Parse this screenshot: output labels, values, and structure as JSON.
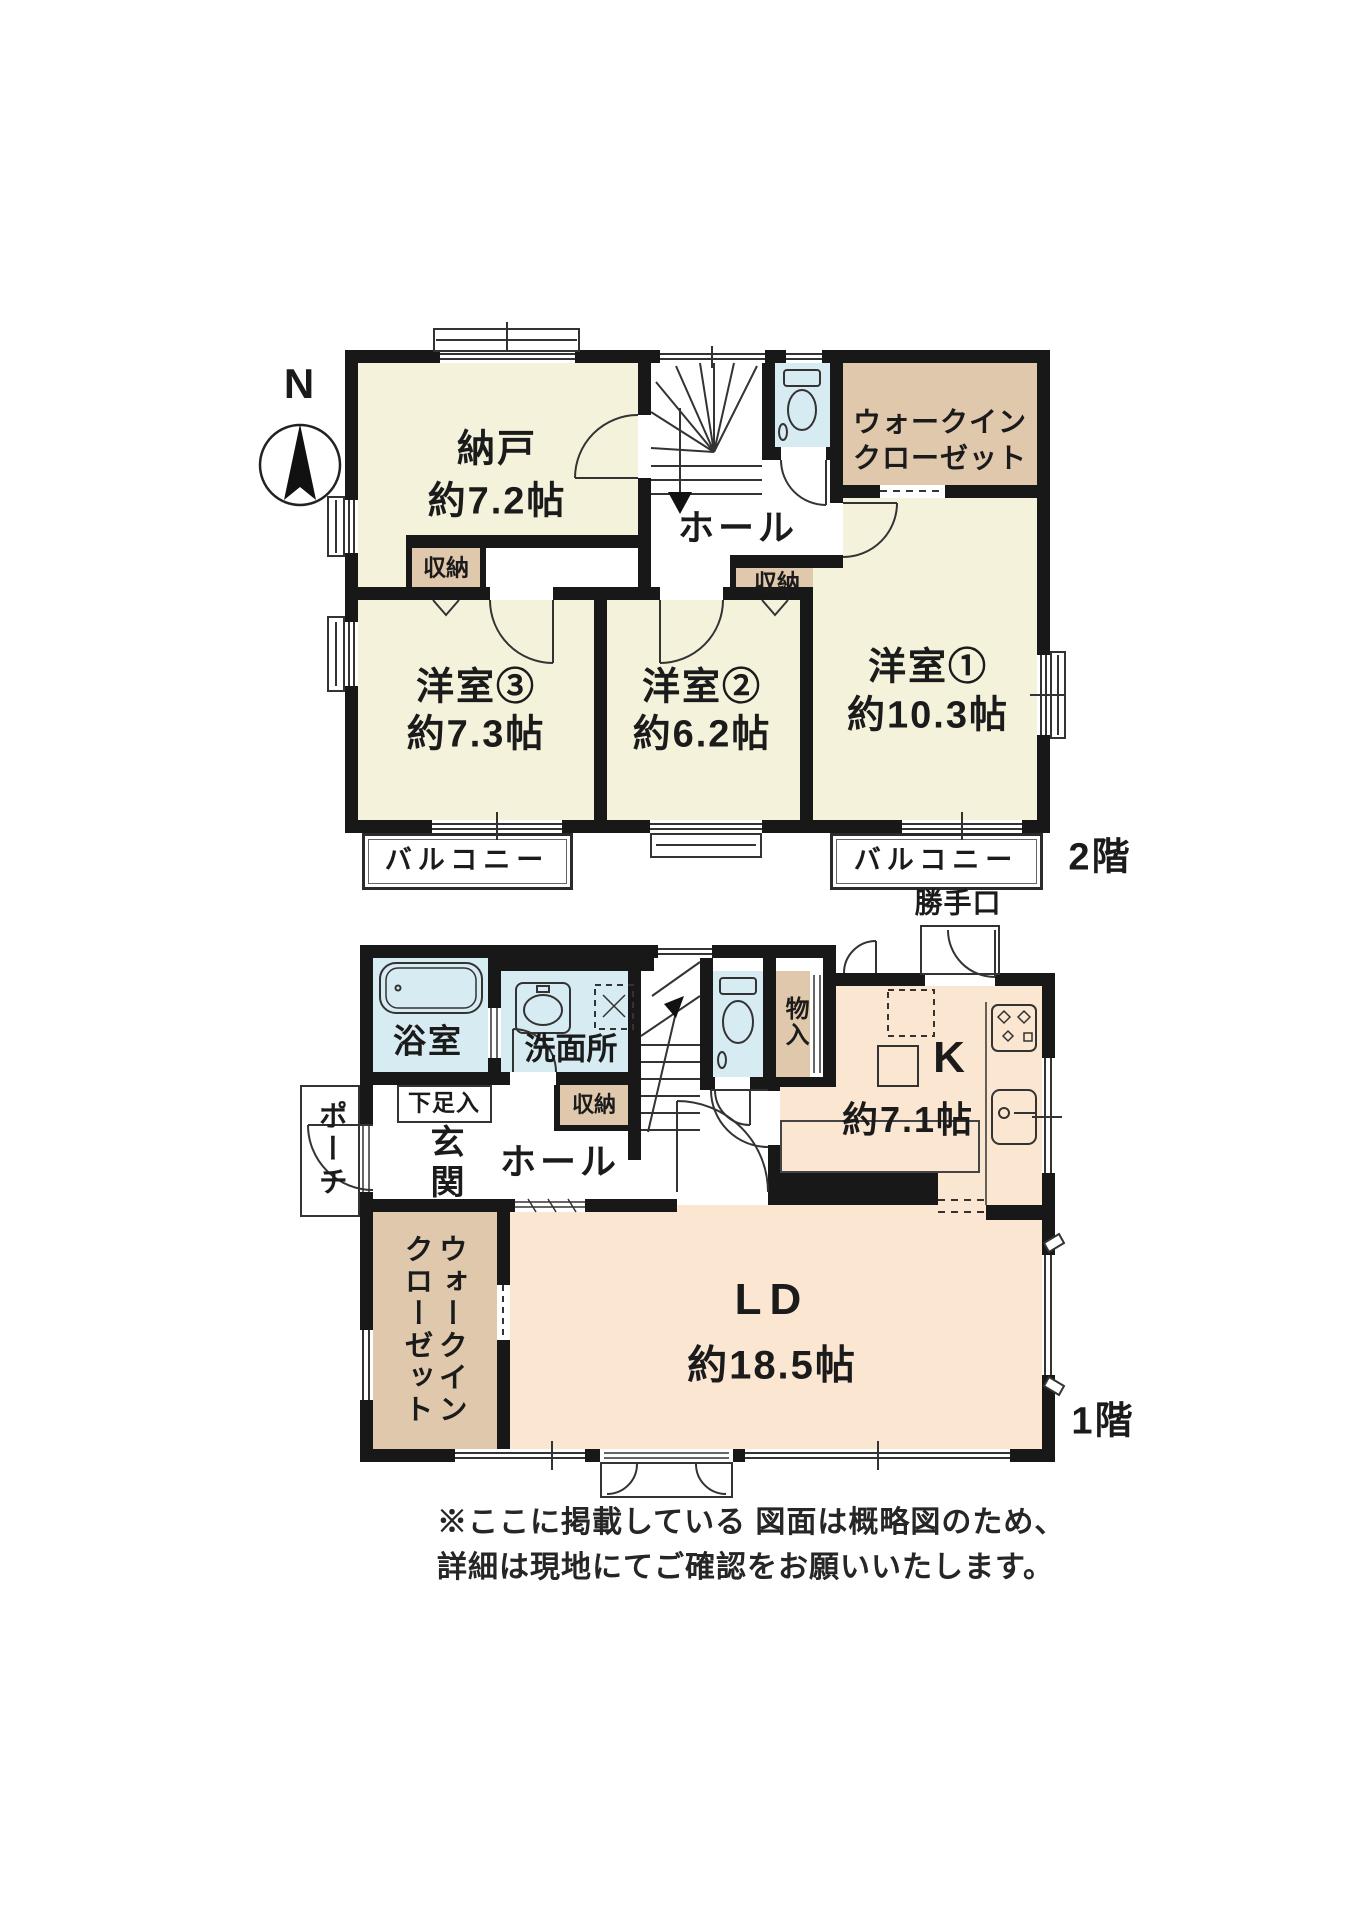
{
  "compass": {
    "north_label": "N"
  },
  "floor2": {
    "floor_label": "2階",
    "nando_label": "納戸",
    "nando_size": "約7.2帖",
    "hall_label": "ホール",
    "wic_line1": "ウォークイン",
    "wic_line2": "クローゼット",
    "storage_left_label": "収納",
    "storage_right_label": "収納",
    "room3_label": "洋室③",
    "room3_size": "約7.3帖",
    "room2_label": "洋室②",
    "room2_size": "約6.2帖",
    "room1_label": "洋室①",
    "room1_size": "約10.3帖",
    "balcony_left_label": "バルコニー",
    "balcony_right_label": "バルコニー"
  },
  "floor1": {
    "floor_label": "1階",
    "bath_label": "浴室",
    "senmenjo_label": "洗面所",
    "shoe_box_label": "下足入",
    "storage_label": "収納",
    "monoire_label": "物入",
    "genkan_label": "玄関",
    "porch_label": "ポーチ",
    "hall_label": "ホール",
    "katteguchi_label": "勝手口",
    "kitchen_label": "K",
    "kitchen_size": "約7.1帖",
    "ld_label": "LD",
    "ld_size": "約18.5帖",
    "wic_line1": "ウォークイン",
    "wic_line2": "クローゼット"
  },
  "note": {
    "line1": "※ここに掲載している 図面は概略図のため、",
    "line2": "詳細は現地にてご確認をお願いいたします。"
  },
  "colors": {
    "wall": "#181818",
    "room_cream": "#f5f2dc",
    "closet_tan": "#dfc8ab",
    "wet_area_blue": "#d7ebf2",
    "living_peach": "#fbe6d1",
    "thin_line": "#333333"
  }
}
